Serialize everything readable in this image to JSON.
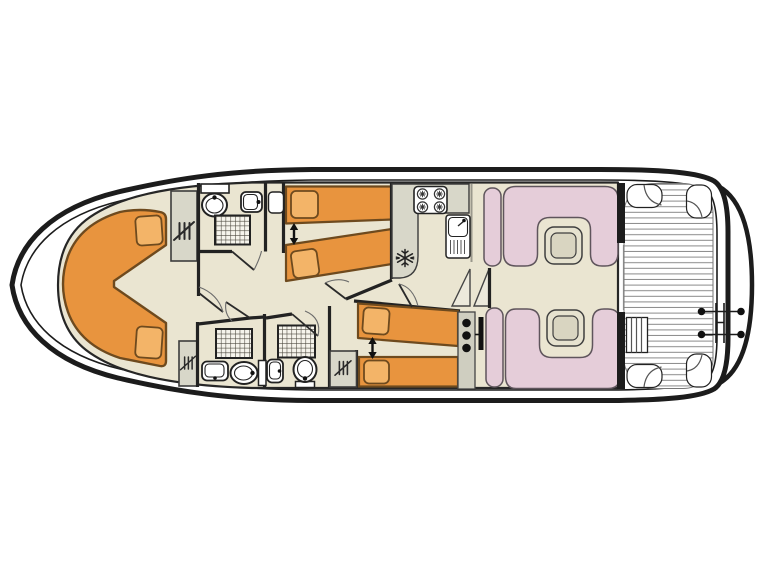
{
  "page": {
    "background": "#ffffff",
    "kind": "boat-deck-floor-plan"
  },
  "colors": {
    "hull_line": "#1c1c1c",
    "hull_fill": "#ffffff",
    "floor": "#eae5d1",
    "bed": "#e8943e",
    "pillow": "#f3b468",
    "bed_outline": "#6e4a1e",
    "furniture_gray": "#d8d7c9",
    "seat_pink": "#e5cdd9",
    "seat_outline": "#5f555c",
    "table_light": "#e6e2cf",
    "table_dark": "#d9d5c1",
    "wall": "#222222",
    "deck_plank_line": "#8a8a8a",
    "shower_grid_line": "#49453b"
  },
  "areas": [
    "bow-cabin-v-berth",
    "forward-bathroom",
    "mid-twin-cabin",
    "galley",
    "mid-bathroom-1",
    "mid-bathroom-2",
    "aft-twin-cabin",
    "salon-dinettes",
    "aft-deck",
    "swim-platform"
  ],
  "icons": [
    "wardrobe-hanger-icon",
    "shower-tray-icon",
    "toilet-icon",
    "washbasin-icon",
    "stove-burners-icon",
    "sink-drainer-icon",
    "fridge-snowflake-icon",
    "joinable-beds-arrow-icon",
    "companionway-steps-icon",
    "deck-ladder-icon",
    "swim-ladder-icon"
  ]
}
